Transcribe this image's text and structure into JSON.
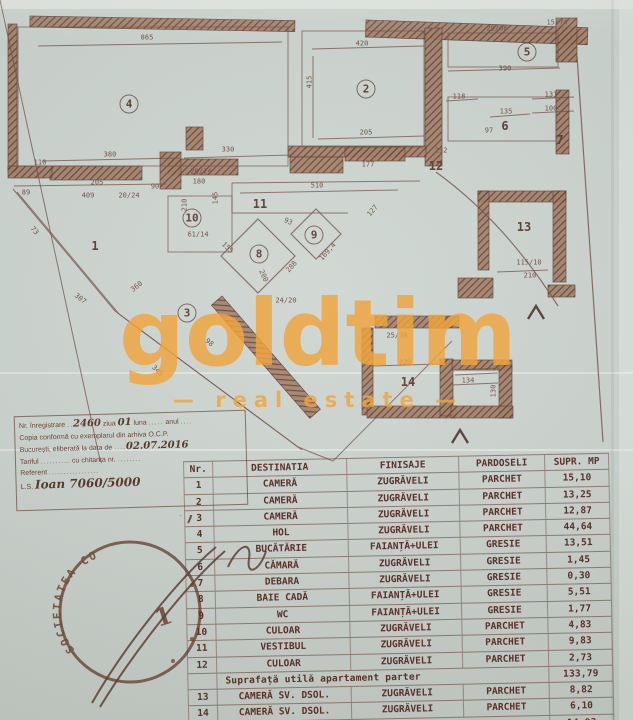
{
  "palette": {
    "paper": "#ccd4cf",
    "ink_dark": "#553427",
    "ink_mid": "#6d4538",
    "accent_orange": "#f0a53d",
    "table_ink": "#5a3129"
  },
  "watermark": {
    "brand": "goldtim",
    "tagline": "—  real estate  —"
  },
  "plan": {
    "rooms": [
      {
        "n": "1",
        "x": 95,
        "y": 246,
        "c": false
      },
      {
        "n": "2",
        "x": 366,
        "y": 89,
        "c": true
      },
      {
        "n": "3",
        "x": 187,
        "y": 313,
        "c": true
      },
      {
        "n": "4",
        "x": 129,
        "y": 104,
        "c": true
      },
      {
        "n": "5",
        "x": 527,
        "y": 52,
        "c": true
      },
      {
        "n": "6",
        "x": 505,
        "y": 126,
        "c": false
      },
      {
        "n": "7",
        "x": 560,
        "y": 140,
        "c": false
      },
      {
        "n": "8",
        "x": 259,
        "y": 254,
        "c": true
      },
      {
        "n": "9",
        "x": 314,
        "y": 235,
        "c": true
      },
      {
        "n": "10",
        "x": 192,
        "y": 218,
        "c": true
      },
      {
        "n": "11",
        "x": 260,
        "y": 204,
        "c": false
      },
      {
        "n": "12",
        "x": 436,
        "y": 166,
        "c": false
      },
      {
        "n": "13",
        "x": 524,
        "y": 227,
        "c": false
      },
      {
        "n": "14",
        "x": 408,
        "y": 382,
        "c": false
      }
    ],
    "dims": [
      {
        "t": "865",
        "x": 147,
        "y": 38,
        "r": 0
      },
      {
        "t": "420",
        "x": 362,
        "y": 44,
        "r": 0
      },
      {
        "t": "29/06",
        "x": 497,
        "y": 29,
        "r": 0
      },
      {
        "t": "15/74",
        "x": 557,
        "y": 23,
        "r": 0
      },
      {
        "t": "390",
        "x": 505,
        "y": 69,
        "r": 0
      },
      {
        "t": "415",
        "x": 310,
        "y": 82,
        "r": -90
      },
      {
        "t": "205",
        "x": 366,
        "y": 133,
        "r": 0
      },
      {
        "t": "118",
        "x": 459,
        "y": 97,
        "r": 0
      },
      {
        "t": "131",
        "x": 551,
        "y": 95,
        "r": 0
      },
      {
        "t": "135",
        "x": 506,
        "y": 112,
        "r": 0
      },
      {
        "t": "100",
        "x": 551,
        "y": 109,
        "r": 0
      },
      {
        "t": "97",
        "x": 489,
        "y": 131,
        "r": 0
      },
      {
        "t": "380",
        "x": 110,
        "y": 155,
        "r": 0
      },
      {
        "t": "330",
        "x": 228,
        "y": 150,
        "r": 0
      },
      {
        "t": "110",
        "x": 40,
        "y": 163,
        "r": 0
      },
      {
        "t": "205",
        "x": 97,
        "y": 183,
        "r": 0
      },
      {
        "t": "90",
        "x": 155,
        "y": 187,
        "r": 0
      },
      {
        "t": "20/24",
        "x": 201,
        "y": 172,
        "r": 0
      },
      {
        "t": "180",
        "x": 199,
        "y": 182,
        "r": 0
      },
      {
        "t": "89",
        "x": 26,
        "y": 193,
        "r": 0
      },
      {
        "t": "409",
        "x": 88,
        "y": 196,
        "r": 0
      },
      {
        "t": "20/24",
        "x": 129,
        "y": 196,
        "r": 0
      },
      {
        "t": "510",
        "x": 317,
        "y": 186,
        "r": 0
      },
      {
        "t": "177",
        "x": 368,
        "y": 165,
        "r": 0
      },
      {
        "t": "232",
        "x": 441,
        "y": 151,
        "r": 0
      },
      {
        "t": "210",
        "x": 185,
        "y": 205,
        "r": -90
      },
      {
        "t": "145",
        "x": 216,
        "y": 198,
        "r": -90
      },
      {
        "t": "61/14",
        "x": 198,
        "y": 235,
        "r": 0
      },
      {
        "t": "155",
        "x": 227,
        "y": 248,
        "r": 45
      },
      {
        "t": "93",
        "x": 288,
        "y": 222,
        "r": 25
      },
      {
        "t": "200",
        "x": 263,
        "y": 276,
        "r": 65
      },
      {
        "t": "288",
        "x": 292,
        "y": 267,
        "r": -48
      },
      {
        "t": "24/20",
        "x": 286,
        "y": 301,
        "r": 0
      },
      {
        "t": "169,4",
        "x": 328,
        "y": 252,
        "r": -48
      },
      {
        "t": "127",
        "x": 373,
        "y": 211,
        "r": -50
      },
      {
        "t": "73",
        "x": 34,
        "y": 231,
        "r": 50
      },
      {
        "t": "307",
        "x": 80,
        "y": 299,
        "r": 38
      },
      {
        "t": "360",
        "x": 137,
        "y": 287,
        "r": -38
      },
      {
        "t": "345",
        "x": 157,
        "y": 371,
        "r": 45
      },
      {
        "t": "98",
        "x": 209,
        "y": 343,
        "r": 40
      },
      {
        "t": "25/30",
        "x": 397,
        "y": 336,
        "r": 0
      },
      {
        "t": "220",
        "x": 405,
        "y": 363,
        "r": 0
      },
      {
        "t": "134",
        "x": 468,
        "y": 381,
        "r": 0
      },
      {
        "t": "130",
        "x": 494,
        "y": 391,
        "r": -90
      },
      {
        "t": "115/10",
        "x": 529,
        "y": 263,
        "r": 0
      },
      {
        "t": "210",
        "x": 530,
        "y": 276,
        "r": 0
      }
    ],
    "walls": [
      [
        30,
        16,
        265,
        11,
        1
      ],
      [
        366,
        20,
        222,
        17,
        2
      ],
      [
        556,
        18,
        21,
        44,
        0
      ],
      [
        425,
        28,
        17,
        138,
        0
      ],
      [
        288,
        146,
        138,
        11,
        0
      ],
      [
        50,
        166,
        92,
        14,
        0
      ],
      [
        168,
        159,
        70,
        16,
        0
      ],
      [
        8,
        24,
        9,
        148,
        0
      ],
      [
        8,
        166,
        44,
        12,
        0
      ],
      [
        160,
        152,
        21,
        37,
        0
      ],
      [
        186,
        127,
        17,
        23,
        0
      ],
      [
        290,
        157,
        53,
        16,
        0
      ],
      [
        345,
        147,
        60,
        14,
        0
      ],
      [
        556,
        90,
        13,
        64,
        0
      ],
      [
        478,
        191,
        88,
        11,
        0
      ],
      [
        478,
        191,
        11,
        79,
        0
      ],
      [
        553,
        191,
        13,
        91,
        0
      ],
      [
        458,
        278,
        35,
        20,
        0
      ],
      [
        548,
        285,
        27,
        12,
        0
      ],
      [
        375,
        316,
        84,
        12,
        0
      ],
      [
        362,
        328,
        11,
        87,
        0
      ],
      [
        367,
        406,
        89,
        12,
        0
      ],
      [
        440,
        359,
        13,
        57,
        0
      ],
      [
        452,
        360,
        60,
        10,
        0
      ],
      [
        499,
        365,
        13,
        53,
        0
      ],
      [
        451,
        406,
        62,
        12,
        0
      ],
      [
        222,
        296,
        150,
        14,
        49
      ]
    ],
    "boxes": [
      [
        18,
        27,
        270,
        139
      ],
      [
        302,
        31,
        122,
        116
      ],
      [
        448,
        33,
        110,
        34
      ],
      [
        448,
        97,
        108,
        44
      ],
      [
        168,
        196,
        64,
        56
      ]
    ],
    "lines": [
      [
        38,
        46,
        282,
        42
      ],
      [
        312,
        49,
        424,
        46
      ],
      [
        448,
        71,
        560,
        68
      ],
      [
        313,
        56,
        313,
        138
      ],
      [
        318,
        139,
        424,
        136
      ],
      [
        42,
        161,
        180,
        158
      ],
      [
        184,
        158,
        292,
        155
      ],
      [
        240,
        193,
        398,
        190
      ],
      [
        446,
        101,
        478,
        99
      ],
      [
        532,
        99,
        574,
        97
      ],
      [
        532,
        113,
        574,
        111
      ],
      [
        490,
        117,
        530,
        114
      ],
      [
        232,
        183,
        420,
        181
      ],
      [
        232,
        213,
        348,
        213
      ],
      [
        232,
        183,
        232,
        213
      ],
      [
        14,
        186,
        166,
        184
      ],
      [
        13,
        189,
        115,
        311
      ],
      [
        17,
        192,
        119,
        314
      ],
      [
        115,
        311,
        298,
        447
      ],
      [
        119,
        314,
        302,
        450
      ],
      [
        298,
        447,
        333,
        461
      ],
      [
        333,
        461,
        452,
        341
      ],
      [
        372,
        366,
        438,
        364
      ],
      [
        455,
        370,
        498,
        368
      ],
      [
        455,
        375,
        498,
        373
      ],
      [
        452,
        385,
        498,
        383
      ],
      [
        497,
        272,
        548,
        270
      ],
      [
        138,
        635,
        0,
        0
      ]
    ],
    "paths": [
      "M436,172 Q505,222 558,306",
      "M577,56 L603,442",
      "M258,219 L295,256 L258,293 L221,256 Z",
      "M316,209 L341,234 L316,259 L291,234 Z"
    ],
    "arrows": [
      {
        "x": 536,
        "y": 312
      },
      {
        "x": 460,
        "y": 436
      }
    ]
  },
  "registration_box": {
    "lines": [
      [
        {
          "p": "Nr. înregistrare "
        },
        {
          "d": ".."
        },
        {
          "h": "2460"
        },
        {
          "p": " ziua "
        },
        {
          "h": "01"
        },
        {
          "p": " luna "
        },
        {
          "d": "....."
        },
        {
          "p": " anul "
        },
        {
          "d": "...."
        }
      ],
      [
        {
          "p": "Copia conformă cu exemplarul din arhiva O.C.P."
        }
      ],
      [
        {
          "p": "București, eliberată la data de "
        },
        {
          "d": "...."
        },
        {
          "h": "02.07.2016"
        }
      ],
      [
        {
          "p": "Tariful "
        },
        {
          "d": ".........."
        },
        {
          "p": " cu chitanța nr. "
        },
        {
          "d": "........"
        }
      ],
      [
        {
          "p": "Referent "
        },
        {
          "d": "................."
        }
      ],
      [
        {
          "p": "L.S. "
        },
        {
          "h": "Ioan  7060/5000"
        }
      ]
    ]
  },
  "stamp": {
    "ring_text": "SOCIETATEA CO",
    "number": "1"
  },
  "table": {
    "headers": [
      "Nr.",
      "DESTINATIA",
      "FINISAJE",
      "PARDOSELI",
      "SUPR. MP"
    ],
    "rows": [
      [
        "1",
        "CAMERĂ",
        "ZUGRĂVELI",
        "PARCHET",
        "15,10"
      ],
      [
        "2",
        "CAMERĂ",
        "ZUGRĂVELI",
        "PARCHET",
        "13,25"
      ],
      [
        "3",
        "CAMERĂ",
        "ZUGRĂVELI",
        "PARCHET",
        "12,87"
      ],
      [
        "4",
        "HOL",
        "ZUGRĂVELI",
        "PARCHET",
        "44,64"
      ],
      [
        "5",
        "BUCĂTĂRIE",
        "FAIANȚĂ+ULEI",
        "GRESIE",
        "13,51"
      ],
      [
        "6",
        "CĂMARĂ",
        "ZUGRĂVELI",
        "GRESIE",
        "1,45"
      ],
      [
        "7",
        "DEBARA",
        "ZUGRĂVELI",
        "GRESIE",
        "0,30"
      ],
      [
        "8",
        "BAIE CADĂ",
        "FAIANȚĂ+ULEI",
        "GRESIE",
        "5,51"
      ],
      [
        "9",
        "WC",
        "FAIANȚĂ+ULEI",
        "GRESIE",
        "1,77"
      ],
      [
        "10",
        "CULOAR",
        "ZUGRĂVELI",
        "PARCHET",
        "4,83"
      ],
      [
        "11",
        "VESTIBUL",
        "ZUGRĂVELI",
        "PARCHET",
        "9,83"
      ],
      [
        "12",
        "CULOAR",
        "ZUGRĂVELI",
        "PARCHET",
        "2,73"
      ]
    ],
    "subtotal_parter": {
      "label": "Suprafață utilă apartament parter",
      "value": "133,79"
    },
    "basement_rows": [
      [
        "13",
        "CAMERĂ SV. DSOL.",
        "ZUGRĂVELI",
        "PARCHET",
        "8,82"
      ],
      [
        "14",
        "CAMERĂ SV. DSOL.",
        "ZUGRĂVELI",
        "PARCHET",
        "6,10"
      ]
    ],
    "subtotal_demisol": {
      "label": "Suprafață utilă apartament demisol",
      "value": "14,93"
    },
    "total": {
      "label": "Suprafață totală apartament",
      "value": "148,72"
    }
  }
}
